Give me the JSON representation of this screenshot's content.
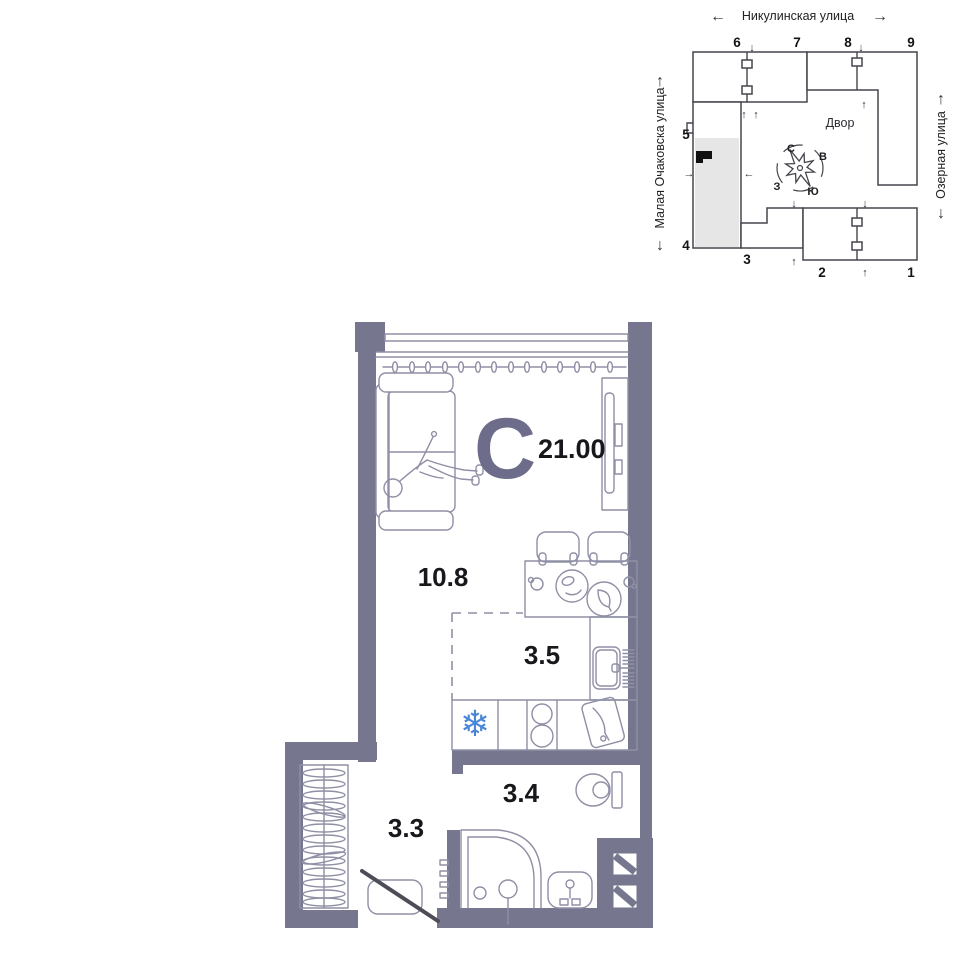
{
  "site_plan": {
    "street_top": "Никулинская улица",
    "street_left": "Малая Очаковска улица",
    "street_right": "Озерная улица",
    "courtyard": "Двор",
    "compass": {
      "n": "С",
      "e": "В",
      "s": "Ю",
      "w": "З"
    },
    "buildings": [
      {
        "label": "1"
      },
      {
        "label": "2"
      },
      {
        "label": "3"
      },
      {
        "label": "4"
      },
      {
        "label": "5"
      },
      {
        "label": "6"
      },
      {
        "label": "7"
      },
      {
        "label": "8"
      },
      {
        "label": "9"
      }
    ]
  },
  "floor_plan": {
    "type_letter": "С",
    "total_area": "21.00",
    "rooms": [
      {
        "id": "living-room",
        "area": "10.8"
      },
      {
        "id": "kitchen",
        "area": "3.5"
      },
      {
        "id": "bathroom",
        "area": "3.4"
      },
      {
        "id": "hallway",
        "area": "3.3"
      }
    ]
  },
  "icons": {
    "snowflake": "❄",
    "arrow_left": "←",
    "arrow_right": "→",
    "arrow_up": "↑",
    "arrow_down": "↓"
  },
  "colors": {
    "wall": "#76768f",
    "furniture_line": "#8f8fa5",
    "accent_letter": "#6d6d8b",
    "snowflake_blue": "#4a86d8",
    "highlight_building": "#e6e6e6",
    "marker_black": "#111111"
  }
}
